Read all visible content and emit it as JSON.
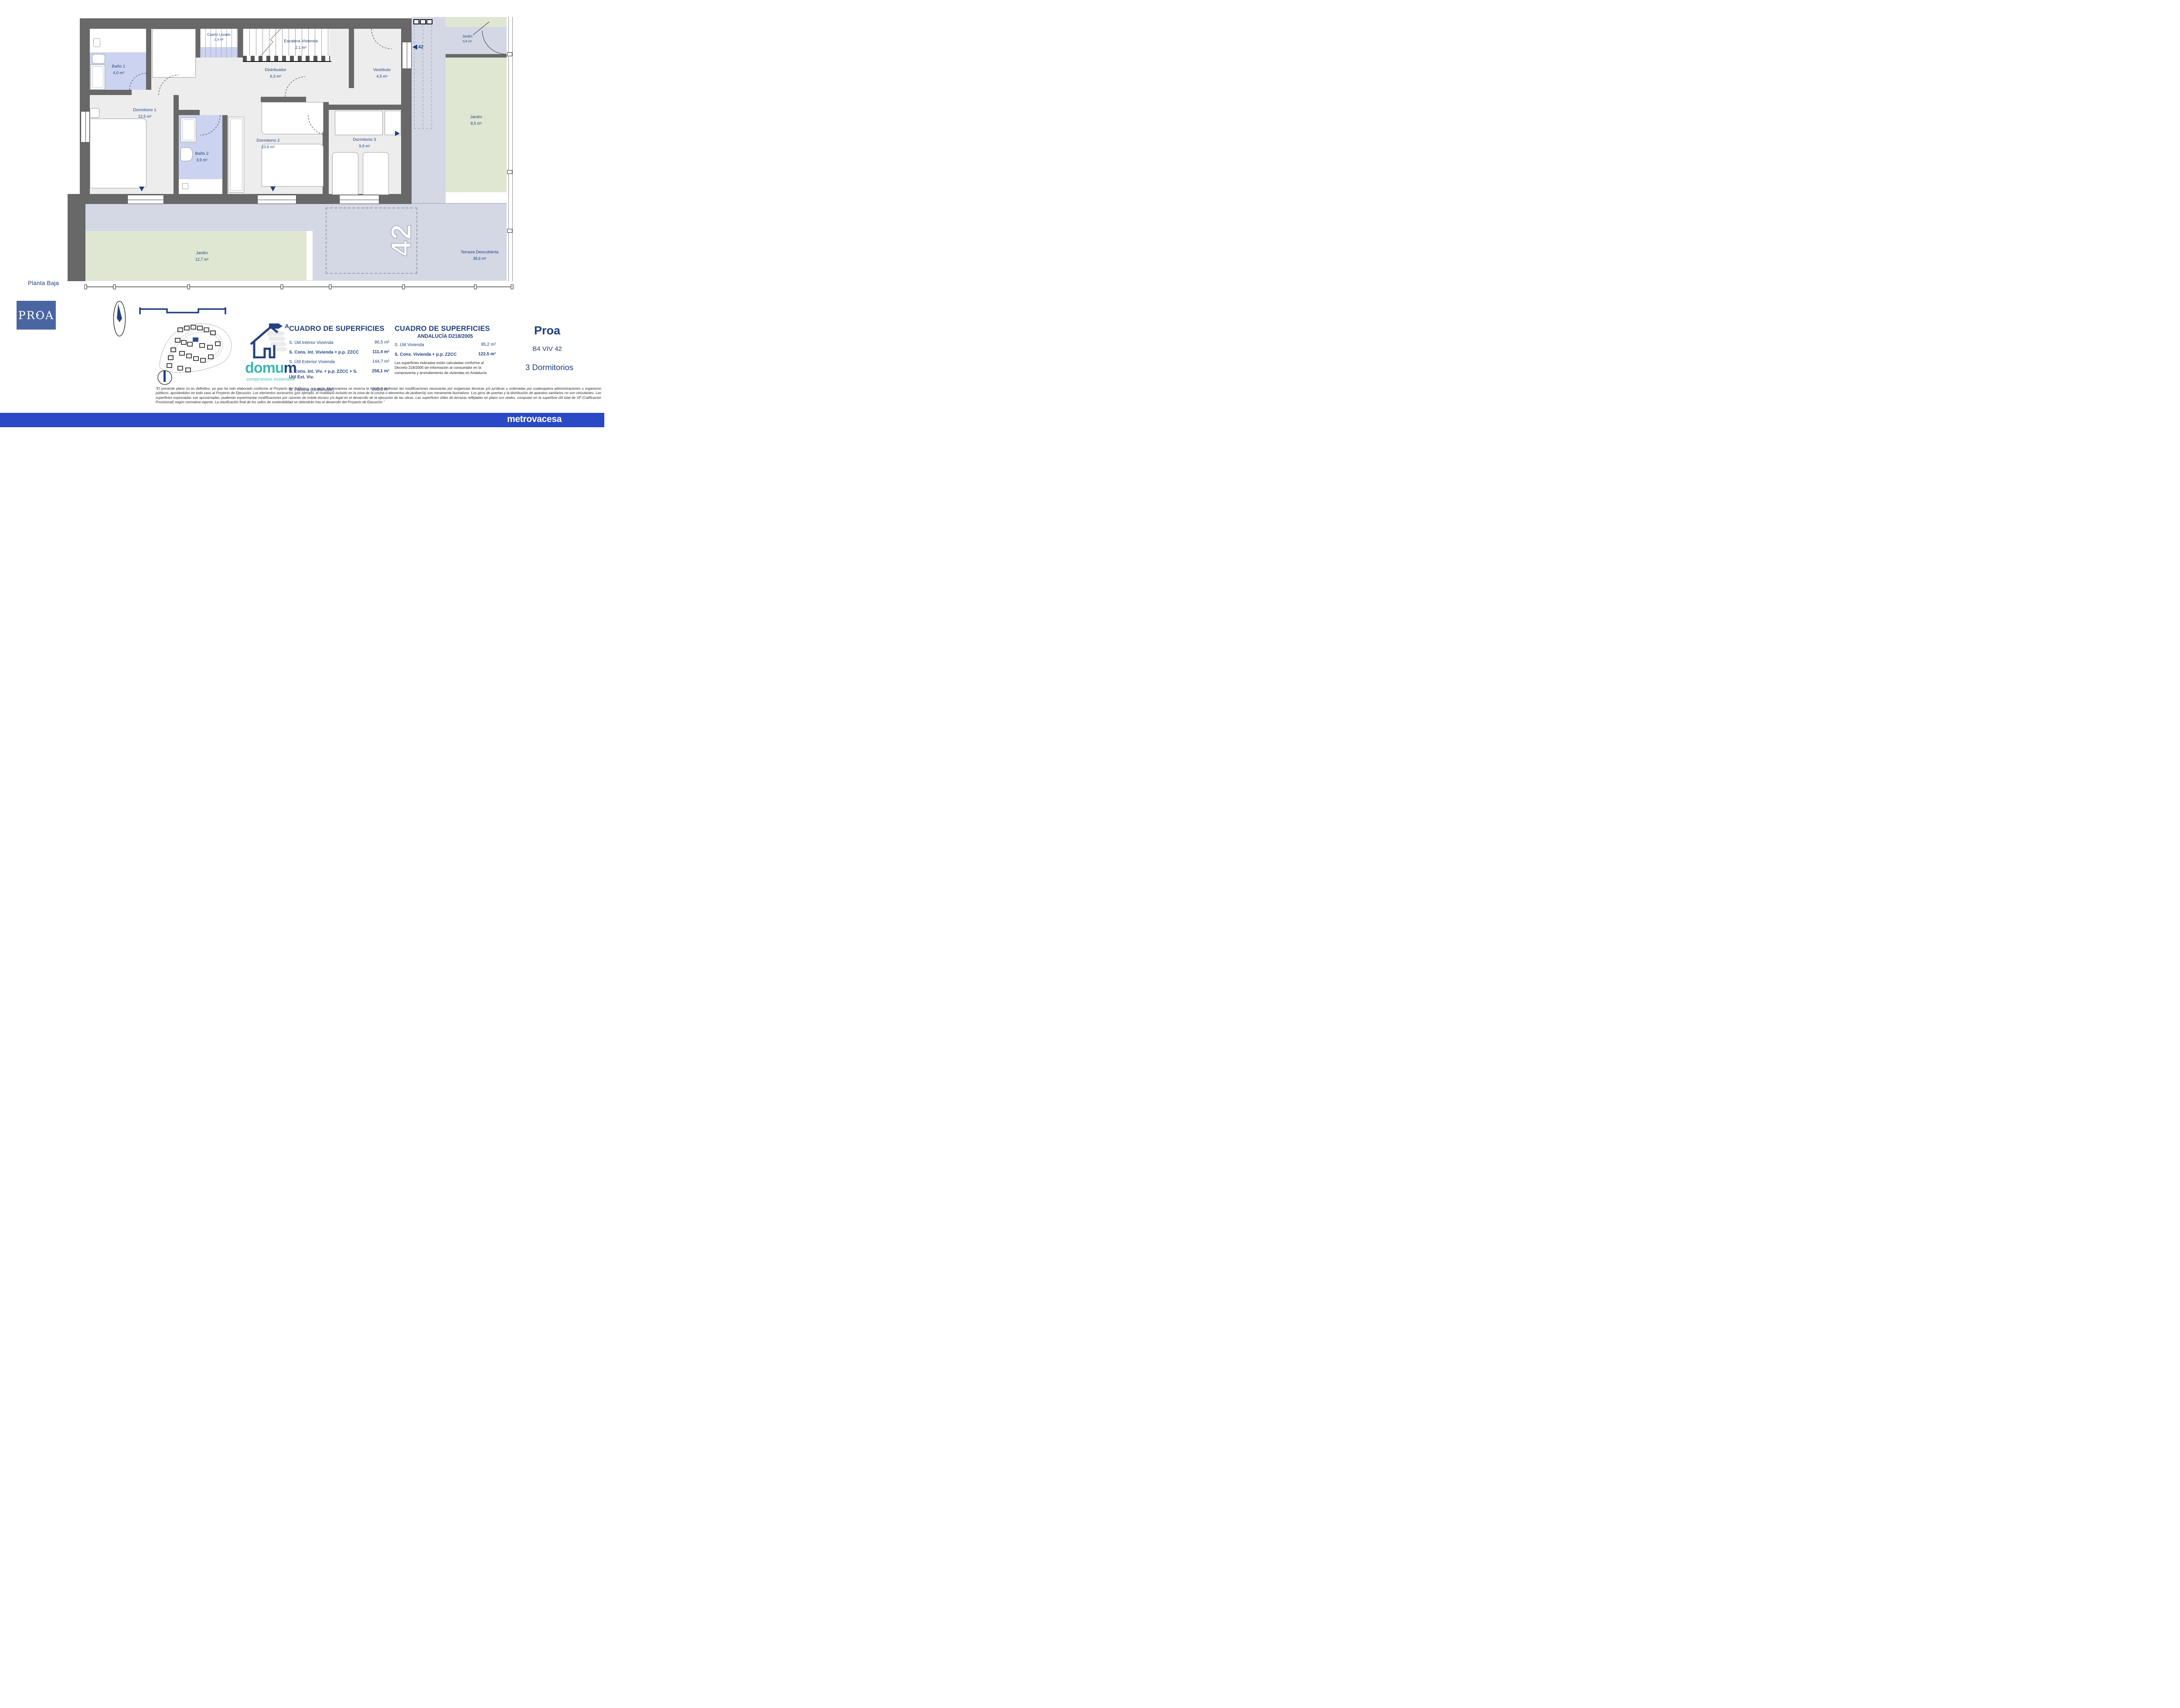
{
  "page": {
    "floor_label": "Planta Baja"
  },
  "plan": {
    "unit_number": "42",
    "rooms": [
      {
        "name": "Baño 1",
        "area": "4,0 m²"
      },
      {
        "name": "Cuarto Lavado",
        "area": "1,3 m²"
      },
      {
        "name": "Escalera Vivienda",
        "area": "2,1 m²"
      },
      {
        "name": "Distribuidor",
        "area": "6,3 m²"
      },
      {
        "name": "Vestíbulo",
        "area": "4,5 m²"
      },
      {
        "name": "Jardín",
        "area": "0,6 m²"
      },
      {
        "name": "Dormitorio 1",
        "area": "12,5 m²"
      },
      {
        "name": "Baño 2",
        "area": "3,9 m²"
      },
      {
        "name": "Dormitorio 2",
        "area": "10,6 m²"
      },
      {
        "name": "Dormitorio 3",
        "area": "9,9 m²"
      },
      {
        "name": "Jardín",
        "area": "8,5 m²"
      },
      {
        "name": "Jardín",
        "area": "12,7 m²"
      },
      {
        "name": "Terraza Descubierta",
        "area": "38,6 m²"
      }
    ]
  },
  "tables": {
    "main": {
      "title": "CUADRO DE SUPERFICIES",
      "rows": [
        {
          "label": "S. Útil Interior Vivienda",
          "value": "86,5 m²"
        },
        {
          "label": "S. Cons. Int. Vivienda + p.p. ZZCC",
          "value": "111,4 m²"
        },
        {
          "label": "S. Útil Exterior Vivienda",
          "value": "144,7 m²"
        },
        {
          "label": "S. Cons. Int. Viv. + p.p. ZZCC + S. Útil Ext. Viv.",
          "value": "256,1 m²"
        },
        {
          "label": "S. Parcela (Unifamiliar)",
          "value": "202,0 m²"
        }
      ]
    },
    "andalucia": {
      "title": "CUADRO DE SUPERFICIES",
      "subtitle": "ANDALUCÍA D218/2005",
      "rows": [
        {
          "label": "S. Útil Vivienda",
          "value": "95,2 m²"
        },
        {
          "label": "S. Cons. Vivienda + p.p. ZZCC",
          "value": "122,5 m²"
        }
      ],
      "note": "Las superficies indicadas están calculadas conforme al Decreto 218/2005 de información al consumidor en la compraventa y arrendamiento de viviendas en Andalucía."
    }
  },
  "project": {
    "name": "Proa",
    "unit": "B4 VIV 42",
    "bedrooms": "3 Dormitorios"
  },
  "branding": {
    "proa_logo": "PROA",
    "proa_star": "✦",
    "domum_prefix": "domu",
    "domum_suffix": "m",
    "domum_tagline": "compromiso sostenible",
    "energy_rating": "A",
    "footer_logo": "metrovacesa"
  },
  "disclaimer": {
    "text": "“El presente plano no es definitivo, ya que ha sido elaborado conforme al Proyecto del Edificio y, por tanto, Metrovacesa se reserva la facultad de incluir las modificaciones necesarias por exigencias técnicas y/o jurídicas u ordenadas por cualesquiera administraciones u organismo públicos, ajustándolos en todo caso al Proyecto de Ejecución. Los elementos accesorios (por ejemplo, el mobiliario incluido en la zona de la cocina o elementos de jardinería) son meramente ilustrativos. Los giros de puertas y la distribución de aparatos sanitarios no son vinculantes. Las superficies expresadas son aproximadas, pudiendo experimentar modificaciones por razones de índole técnico y/o legal en el desarrollo de la ejecución de las obras. Las superficies útiles de terrazas reflejadas en plano son reales, computan en la superficie útil total de VP (Calificación Provisional) según normativa vigente. La clasificación final de los sellos de sostenibilidad se obtendrán tras el desarrollo del Proyecto de Ejecución.”"
  },
  "colors": {
    "label_navy": "#1D3E7D",
    "wall_gray": "#686868",
    "bath_lavender": "#CCD3F0",
    "garden_green": "#DFE7D3",
    "terrace_blue": "#D3D8E4",
    "room_gray": "#EDEDED",
    "footer_blue": "#2A49C4",
    "proa_blue": "#4A66A2",
    "domum_teal": "#3CB6AE"
  }
}
